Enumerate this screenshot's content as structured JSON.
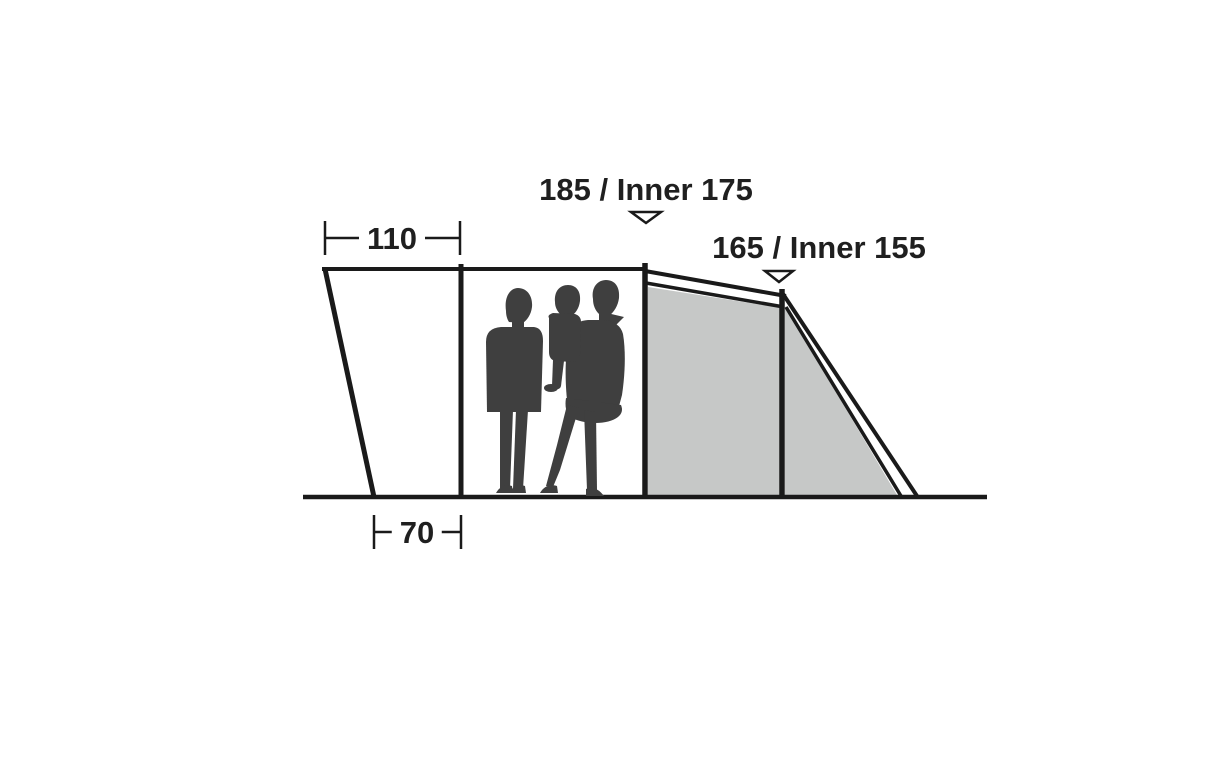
{
  "diagram": {
    "type": "tent-side-profile-dimensions",
    "dimensions": {
      "porch_width_top": "110",
      "porch_width_bottom": "70",
      "height_center": "185 / Inner 175",
      "height_rear": "165 / Inner 155"
    },
    "markers": [
      {
        "name": "height-marker-center",
        "points_to": "center-pole"
      },
      {
        "name": "height-marker-rear",
        "points_to": "rear-pole"
      }
    ],
    "colors": {
      "line": "#1a1a1a",
      "text": "#1f1f1f",
      "compartment_fill": "#c6c8c7",
      "silhouette": "#3f3f3f",
      "marker_fill": "#ffffff",
      "background": "#ffffff"
    }
  }
}
